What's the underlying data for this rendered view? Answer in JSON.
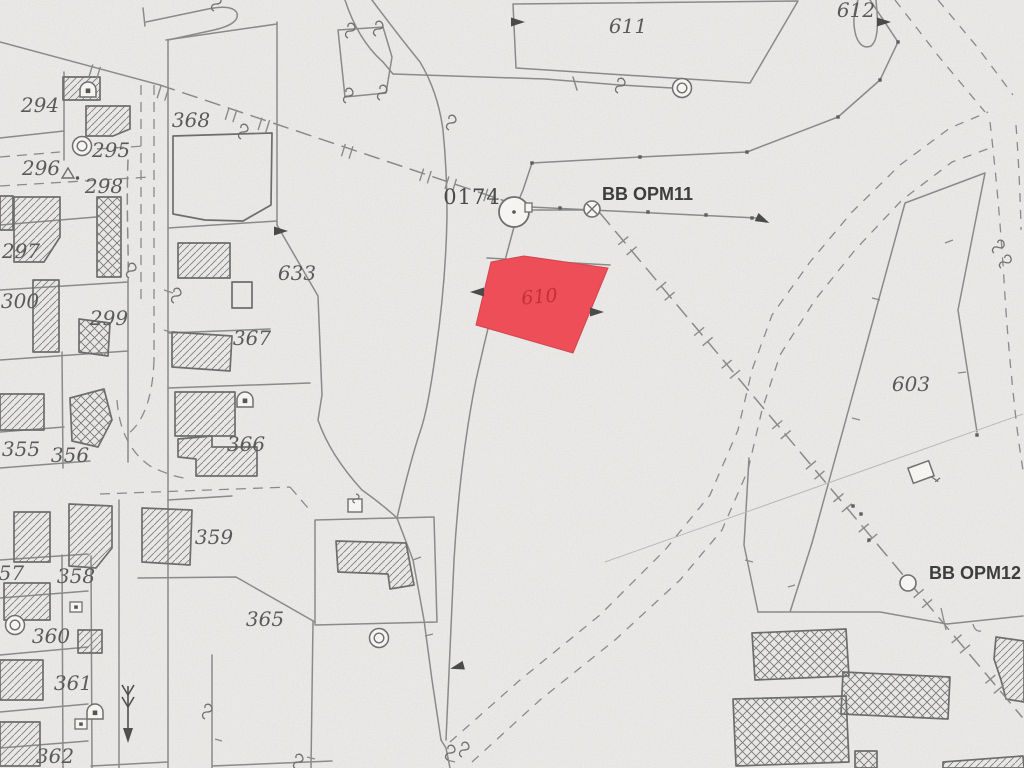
{
  "map": {
    "type": "cadastral-plan",
    "background_color": "#f5f4f1",
    "line_color": "#8a8a8a",
    "building_line_color": "#6d6d6d",
    "label_color": "#5a5a5a",
    "highlight_parcel": {
      "id": "610",
      "fill_color": "#ee4e57",
      "label_color": "#c43039",
      "label_x": 540,
      "label_y": 303
    },
    "survey_point": {
      "label": "0174",
      "x": 472,
      "y": 204
    },
    "opm_markers": [
      {
        "label": "BB OPM11",
        "x": 602,
        "y": 200
      },
      {
        "label": "BB OPM12",
        "x": 929,
        "y": 579
      }
    ],
    "parcel_labels": [
      {
        "text": "294",
        "x": 40,
        "y": 112
      },
      {
        "text": "295",
        "x": 111,
        "y": 157
      },
      {
        "text": "296",
        "x": 41,
        "y": 175
      },
      {
        "text": "298",
        "x": 104,
        "y": 193
      },
      {
        "text": "297",
        "x": 21,
        "y": 258
      },
      {
        "text": "300",
        "x": 20,
        "y": 308
      },
      {
        "text": "299",
        "x": 109,
        "y": 325
      },
      {
        "text": "368",
        "x": 191,
        "y": 127
      },
      {
        "text": "633",
        "x": 297,
        "y": 280
      },
      {
        "text": "367",
        "x": 252,
        "y": 345
      },
      {
        "text": "366",
        "x": 246,
        "y": 451
      },
      {
        "text": "355",
        "x": 21,
        "y": 456
      },
      {
        "text": "356",
        "x": 70,
        "y": 462
      },
      {
        "text": "357",
        "x": 5,
        "y": 580
      },
      {
        "text": "358",
        "x": 76,
        "y": 583
      },
      {
        "text": "359",
        "x": 214,
        "y": 544
      },
      {
        "text": "360",
        "x": 51,
        "y": 643
      },
      {
        "text": "361",
        "x": 73,
        "y": 690
      },
      {
        "text": "362",
        "x": 55,
        "y": 763
      },
      {
        "text": "365",
        "x": 265,
        "y": 626
      },
      {
        "text": "611",
        "x": 628,
        "y": 33
      },
      {
        "text": "612",
        "x": 856,
        "y": 17
      },
      {
        "text": "603",
        "x": 911,
        "y": 391
      }
    ],
    "symbols": [
      {
        "name": "survey-circle",
        "x": 514,
        "y": 212
      },
      {
        "name": "crossed-circle",
        "x": 592,
        "y": 209
      },
      {
        "name": "line-circle",
        "x": 908,
        "y": 583
      },
      {
        "name": "well-circle",
        "x": 682,
        "y": 88
      },
      {
        "name": "well-circle",
        "x": 379,
        "y": 638
      },
      {
        "name": "well-circle",
        "x": 82,
        "y": 146
      },
      {
        "name": "well-circle",
        "x": 15,
        "y": 625
      },
      {
        "name": "arch-dot",
        "x": 88,
        "y": 90
      },
      {
        "name": "arch-dot",
        "x": 245,
        "y": 400
      },
      {
        "name": "arch-dot",
        "x": 95,
        "y": 712
      },
      {
        "name": "square-dot",
        "x": 76,
        "y": 607
      },
      {
        "name": "square-dot",
        "x": 81,
        "y": 724
      },
      {
        "name": "square-hook",
        "x": 355,
        "y": 505
      },
      {
        "name": "diamond-hook",
        "x": 921,
        "y": 472,
        "rot": -20
      },
      {
        "name": "arrow-right",
        "x": 884,
        "y": 22
      },
      {
        "name": "arrow-right",
        "x": 518,
        "y": 22
      },
      {
        "name": "arrow-right",
        "x": 281,
        "y": 231
      },
      {
        "name": "arrow-right",
        "x": 763,
        "y": 220,
        "rot": 25
      },
      {
        "name": "arrow-left",
        "x": 477,
        "y": 292
      },
      {
        "name": "arrow-right",
        "x": 597,
        "y": 312
      },
      {
        "name": "arrow-left",
        "x": 457,
        "y": 667,
        "rot": -15
      },
      {
        "name": "triangle-dot",
        "x": 68,
        "y": 174
      },
      {
        "name": "flow-arrow",
        "x": 128,
        "y": 714
      },
      {
        "name": "gate-hook",
        "x": 218,
        "y": 4
      },
      {
        "name": "gate-hook",
        "x": 245,
        "y": 132
      },
      {
        "name": "gate-hook",
        "x": 352,
        "y": 31
      },
      {
        "name": "gate-hook",
        "x": 380,
        "y": 29
      },
      {
        "name": "gate-hook",
        "x": 350,
        "y": 96
      },
      {
        "name": "gate-hook",
        "x": 384,
        "y": 93
      },
      {
        "name": "gate-hook",
        "x": 453,
        "y": 123
      },
      {
        "name": "gate-hook",
        "x": 622,
        "y": 86
      },
      {
        "name": "gate-hook",
        "x": 133,
        "y": 271
      },
      {
        "name": "gate-hook",
        "x": 178,
        "y": 296
      },
      {
        "name": "gate-hook",
        "x": 1000,
        "y": 248,
        "rot": 20
      },
      {
        "name": "gate-hook",
        "x": 1007,
        "y": 263,
        "rot": 20
      },
      {
        "name": "gate-hook",
        "x": 452,
        "y": 753
      },
      {
        "name": "gate-hook",
        "x": 466,
        "y": 750
      },
      {
        "name": "gate-hook",
        "x": 209,
        "y": 712
      },
      {
        "name": "gate-hook",
        "x": 300,
        "y": 762
      }
    ]
  }
}
